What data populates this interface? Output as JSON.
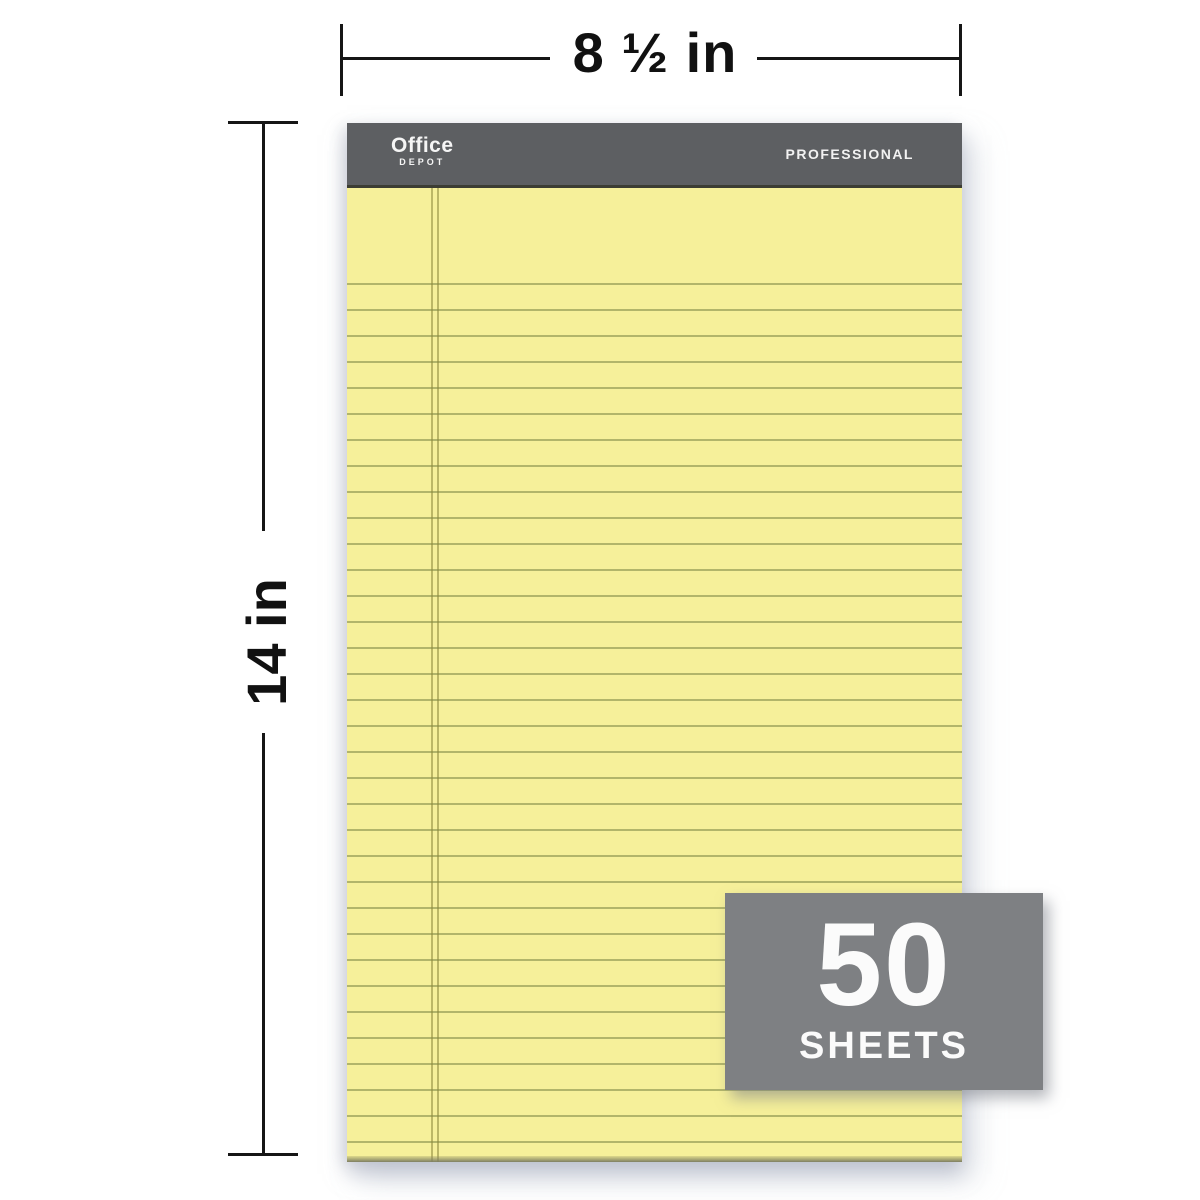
{
  "canvas": {
    "background": "#ffffff"
  },
  "dimension_annotations": {
    "width": {
      "label": "8 ½ in"
    },
    "height": {
      "label": "14 in"
    },
    "line_color": "#161616"
  },
  "pad": {
    "header": {
      "brand_line1": "Office",
      "brand_line2": "DEPOT",
      "series_label": "PROFESSIONAL",
      "band_color": "#5d5f62",
      "text_color": "#f2f2f2"
    },
    "paper": {
      "color": "#f6f09a",
      "rule_line_color": "#b9bd85",
      "margin_line_color": "#b3ad62"
    }
  },
  "badge": {
    "count": "50",
    "label": "SHEETS",
    "background": "#7e8083",
    "text_color": "#fbfbfb"
  }
}
